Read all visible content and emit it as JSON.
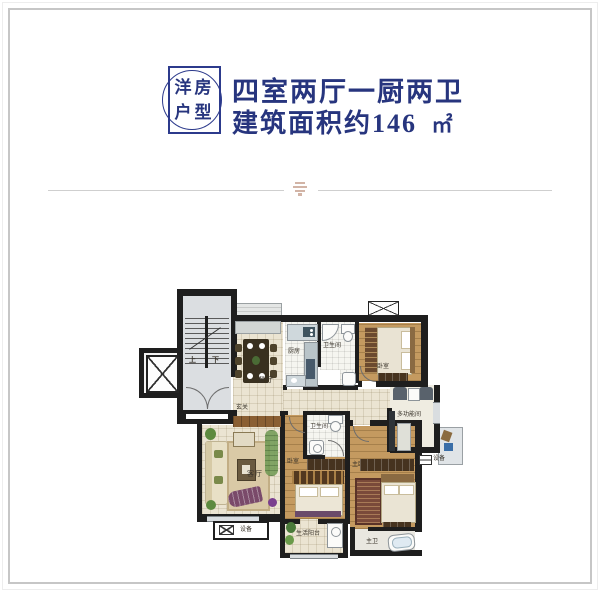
{
  "header": {
    "stamp_line1": "洋房",
    "stamp_line2": "户型",
    "title": "四室两厅一厨两卫",
    "subtitle_prefix": "建筑面积约",
    "area_value": "146",
    "area_unit": "㎡",
    "accent_color": "#27357e"
  },
  "plan": {
    "labels": {
      "stairs_up": "上",
      "stairs_down": "下",
      "dining": "餐厅",
      "kitchen": "厨房",
      "bathroom1": "卫生间",
      "bedroom1": "卧室",
      "foyer": "玄关",
      "living": "客厅",
      "bedroom2": "卧室",
      "bathroom2": "卫生间",
      "master_bedroom": "主卧室",
      "multi_room": "多功能间",
      "equipment_right": "设备",
      "equipment_left": "设备",
      "balcony": "生活阳台",
      "master_bath": "主卫"
    },
    "colors": {
      "wall": "#1e1e1e",
      "tile_floor": "#ebe4d2",
      "wood_floor": "#c49a60",
      "stair_floor": "#dbdee1"
    }
  }
}
